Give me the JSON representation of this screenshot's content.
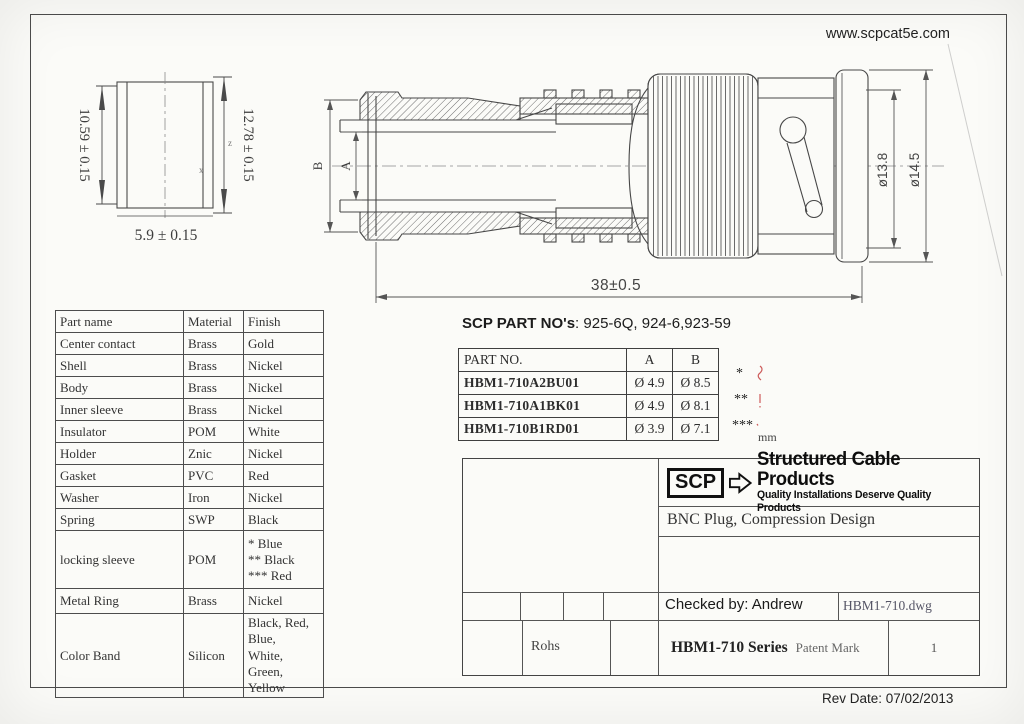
{
  "page": {
    "website": "www.scpcat5e.com",
    "rev_date": "Rev Date: 07/02/2013"
  },
  "left_view": {
    "dim_left": "10.59 ± 0.15",
    "dim_right": "12.78 ± 0.15",
    "dim_bottom": "5.9 ± 0.15",
    "mark_z": "z",
    "mark_x": "x"
  },
  "main_view": {
    "label_a": "A",
    "label_b": "B",
    "dim_length": "38±0.5",
    "dim_dia_inner": "ø13.8",
    "dim_dia_outer": "ø14.5"
  },
  "parts_table": {
    "headers": [
      "Part name",
      "Material",
      "Finish"
    ],
    "rows": [
      {
        "name": "Center contact",
        "material": "Brass",
        "finish": "Gold"
      },
      {
        "name": "Shell",
        "material": "Brass",
        "finish": "Nickel"
      },
      {
        "name": "Body",
        "material": "Brass",
        "finish": "Nickel"
      },
      {
        "name": "Inner sleeve",
        "material": "Brass",
        "finish": "Nickel"
      },
      {
        "name": "Insulator",
        "material": "POM",
        "finish": "White"
      },
      {
        "name": "Holder",
        "material": "Znic",
        "finish": "Nickel"
      },
      {
        "name": "Gasket",
        "material": "PVC",
        "finish": "Red"
      },
      {
        "name": "Washer",
        "material": "Iron",
        "finish": "Nickel"
      },
      {
        "name": "Spring",
        "material": "SWP",
        "finish": "Black"
      },
      {
        "name": "locking sleeve",
        "material": "POM",
        "finish": "* Blue\n** Black\n*** Red"
      },
      {
        "name": "Metal Ring",
        "material": "Brass",
        "finish": "Nickel"
      },
      {
        "name": "Color Band",
        "material": "Silicon",
        "finish": "Black, Red, Blue,\nWhite, Green,\nYellow"
      }
    ]
  },
  "scp_parts": {
    "label": "SCP PART NO's",
    "numbers": ": 925-6Q, 924-6,923-59"
  },
  "partno_table": {
    "headers": [
      "PART NO.",
      "A",
      "B"
    ],
    "unit": "mm",
    "rows": [
      {
        "pn": "HBM1-710A2BU01",
        "a": "Ø 4.9",
        "b": "Ø 8.5",
        "mark": "*"
      },
      {
        "pn": "HBM1-710A1BK01",
        "a": "Ø 4.9",
        "b": "Ø 8.1",
        "mark": "**"
      },
      {
        "pn": "HBM1-710B1RD01",
        "a": "Ø 3.9",
        "b": "Ø 7.1",
        "mark": "***"
      }
    ]
  },
  "title_block": {
    "logo": "SCP",
    "brand": "Structured Cable Products",
    "tagline": "Quality Installations Deserve Quality Products",
    "product": "BNC Plug, Compression Design",
    "checked_by": "Checked by: Andrew",
    "dwg": "HBM1-710.dwg",
    "rohs": "Rohs",
    "series": "HBM1-710 Series",
    "patent": "Patent Mark",
    "sheet": "1"
  }
}
